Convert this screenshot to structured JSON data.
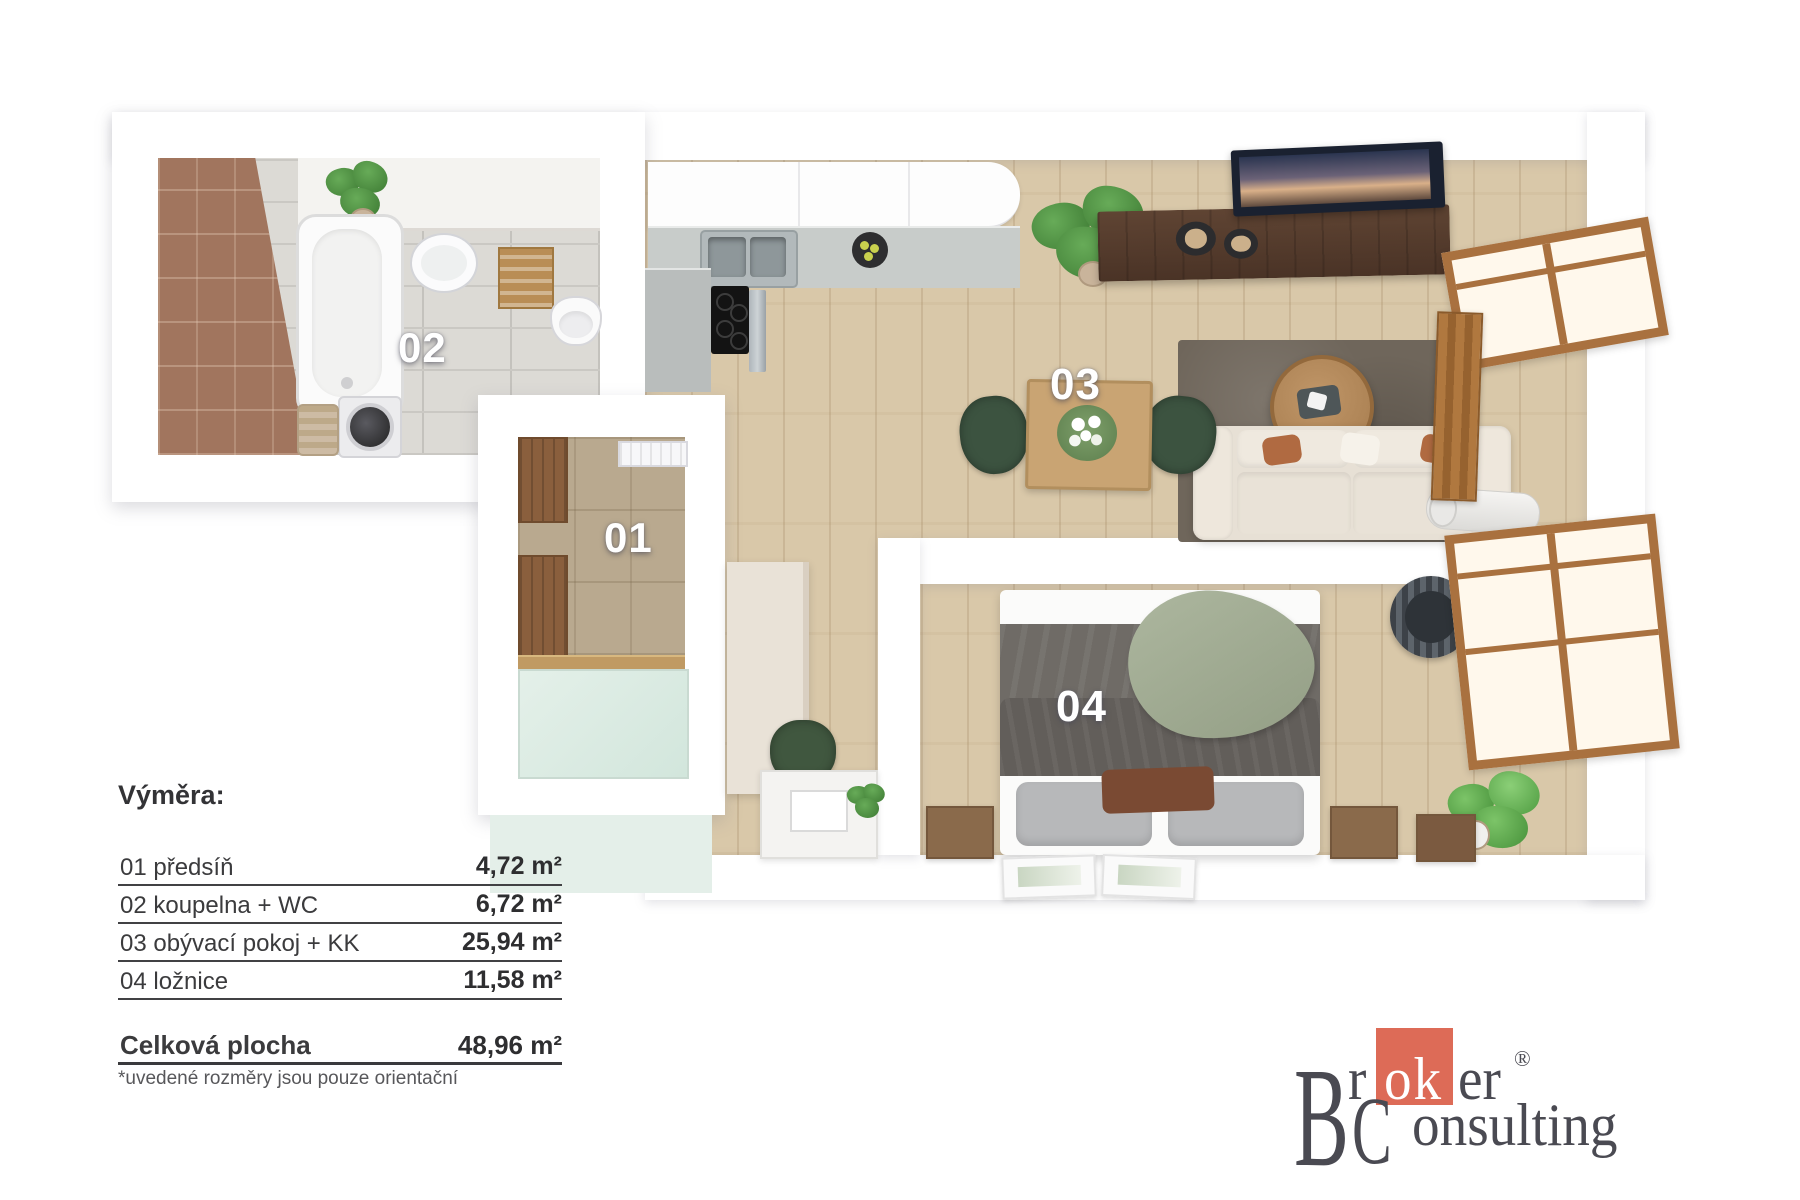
{
  "floorplan": {
    "labels": {
      "r01": "01",
      "r02": "02",
      "r03": "03",
      "r04": "04"
    },
    "colors": {
      "wall": "#FFFFFF",
      "wood_floor": "#D9C8A9",
      "bath_tile": "#DCDAD5",
      "brown_wall_tile": "#A1755E",
      "hall_tile": "#B9A98F",
      "entry_glass": "#DCEBE3",
      "room_label_text": "#FFFFFF"
    }
  },
  "legend": {
    "title": "Výměra:",
    "rows": [
      {
        "name": "01 předsíň",
        "area": "4,72 m²"
      },
      {
        "name": "02 koupelna + WC",
        "area": "6,72 m²"
      },
      {
        "name": "03 obývací pokoj + KK",
        "area": "25,94 m²"
      },
      {
        "name": "04 ložnice",
        "area": "11,58 m²"
      }
    ],
    "total_label": "Celková plocha",
    "total_area": "48,96 m²",
    "footnote": "*uvedené rozměry jsou pouze orientační"
  },
  "logo": {
    "b": "B",
    "top_pre": "r",
    "accent_letters": "ok",
    "top_post": "er",
    "registered": "®",
    "c": "C",
    "bottom_rest": "onsulting",
    "accent_color": "#DD6B57",
    "text_color": "#4A4A52"
  }
}
